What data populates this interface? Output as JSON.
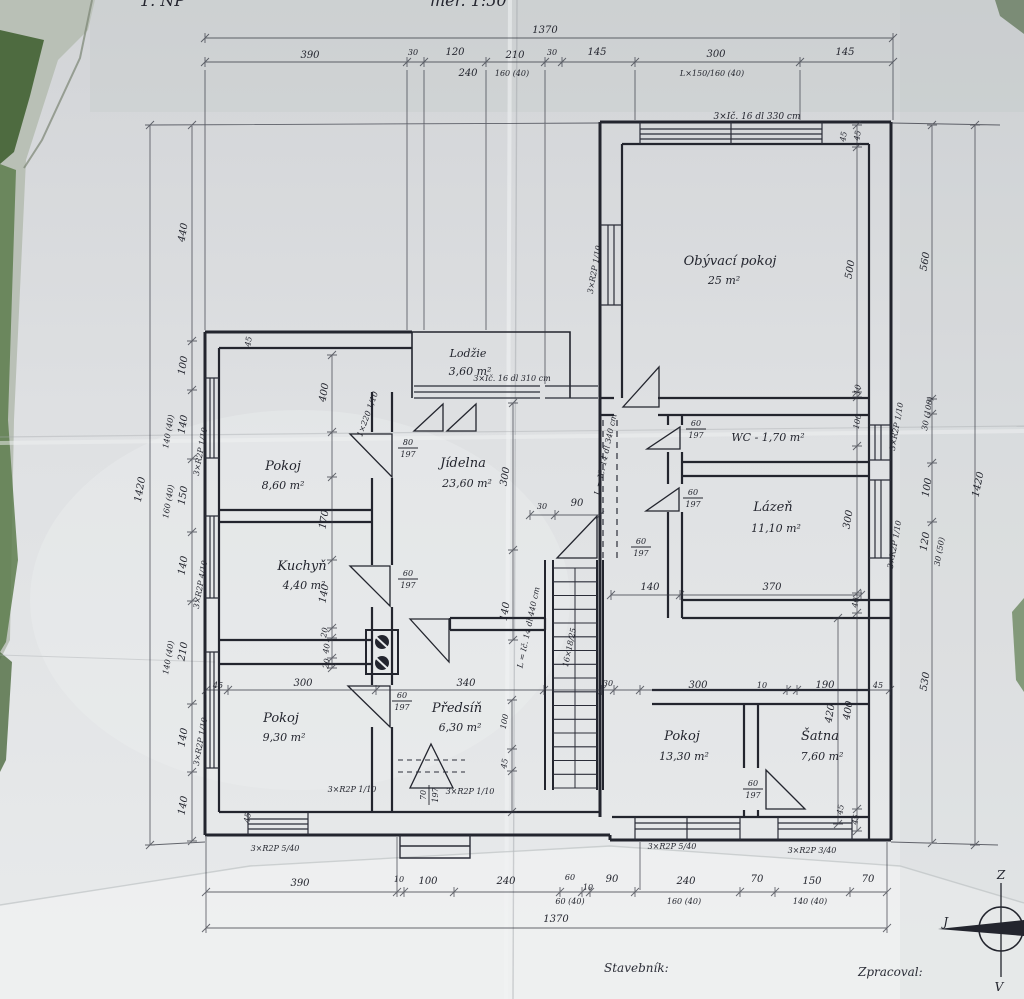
{
  "colors": {
    "ink": "#23252e",
    "ink_light": "#32343f",
    "paper": "#dfe1e3",
    "paper_bright": "#f1f3f3",
    "foliage": "#5d7c4e",
    "foliage_dark": "#3f5a35"
  },
  "title": {
    "left": "1. NP",
    "right": "měř. 1:50"
  },
  "footer": {
    "stavebnik": "Stavebník:",
    "zpracoval": "Zpracoval:"
  },
  "compass": {
    "top": "Z",
    "bottom": "V",
    "left": "J"
  },
  "rooms": [
    {
      "name": "Obývací pokoj",
      "area": "25 m²",
      "x": 730,
      "y": 265,
      "ax": 724,
      "ay": 284
    },
    {
      "name": "Lodžie",
      "area": "3,60 m²",
      "x": 468,
      "y": 357,
      "ax": 470,
      "ay": 375,
      "s": 11
    },
    {
      "name": "Pokoj",
      "area": "8,60 m²",
      "x": 283,
      "y": 470,
      "ax": 283,
      "ay": 489
    },
    {
      "name": "Jídelna",
      "area": "23,60 m²",
      "x": 463,
      "y": 467,
      "ax": 467,
      "ay": 487
    },
    {
      "name": "Kuchyň",
      "area": "4,40 m²",
      "x": 302,
      "y": 570,
      "ax": 304,
      "ay": 589
    },
    {
      "name": "WC - 1,70 m²",
      "area": "",
      "x": 768,
      "y": 441,
      "s": 11
    },
    {
      "name": "Lázeň",
      "area": "11,10 m²",
      "x": 773,
      "y": 511,
      "ax": 776,
      "ay": 532
    },
    {
      "name": "Pokoj",
      "area": "9,30 m²",
      "x": 281,
      "y": 722,
      "ax": 284,
      "ay": 741
    },
    {
      "name": "Předsíň",
      "area": "6,30 m²",
      "x": 457,
      "y": 712,
      "ax": 460,
      "ay": 731
    },
    {
      "name": "Pokoj",
      "area": "13,30 m²",
      "x": 682,
      "y": 740,
      "ax": 684,
      "ay": 760
    },
    {
      "name": "Šatna",
      "area": "7,60 m²",
      "x": 820,
      "y": 740,
      "ax": 822,
      "ay": 760
    }
  ],
  "dimensions": [
    {
      "t": "1370",
      "x": 545,
      "y": 33
    },
    {
      "t": "390",
      "x": 310,
      "y": 58
    },
    {
      "t": "30",
      "x": 413,
      "y": 55,
      "s": 8
    },
    {
      "t": "120",
      "x": 455,
      "y": 55
    },
    {
      "t": "240",
      "x": 468,
      "y": 76
    },
    {
      "t": "210",
      "x": 515,
      "y": 58
    },
    {
      "t": "160 (40)",
      "x": 512,
      "y": 76,
      "s": 8
    },
    {
      "t": "30",
      "x": 552,
      "y": 55,
      "s": 8
    },
    {
      "t": "145",
      "x": 597,
      "y": 55
    },
    {
      "t": "300",
      "x": 716,
      "y": 57
    },
    {
      "t": "L×150/160 (40)",
      "x": 712,
      "y": 76,
      "s": 8
    },
    {
      "t": "145",
      "x": 845,
      "y": 55
    },
    {
      "t": "390",
      "x": 300,
      "y": 886
    },
    {
      "t": "10",
      "x": 399,
      "y": 882,
      "s": 8
    },
    {
      "t": "100",
      "x": 428,
      "y": 884
    },
    {
      "t": "240",
      "x": 506,
      "y": 884
    },
    {
      "t": "60",
      "x": 570,
      "y": 880,
      "s": 8
    },
    {
      "t": "60 (40)",
      "x": 570,
      "y": 904,
      "s": 8
    },
    {
      "t": "10",
      "x": 588,
      "y": 890,
      "s": 8
    },
    {
      "t": "90",
      "x": 612,
      "y": 882
    },
    {
      "t": "240",
      "x": 686,
      "y": 884
    },
    {
      "t": "160 (40)",
      "x": 684,
      "y": 904,
      "s": 8
    },
    {
      "t": "70",
      "x": 757,
      "y": 882
    },
    {
      "t": "150",
      "x": 812,
      "y": 884
    },
    {
      "t": "140 (40)",
      "x": 810,
      "y": 904,
      "s": 8
    },
    {
      "t": "70",
      "x": 868,
      "y": 882
    },
    {
      "t": "1370",
      "x": 556,
      "y": 922
    },
    {
      "t": "1420",
      "x": 143,
      "y": 490,
      "rot": -80
    },
    {
      "t": "440",
      "x": 186,
      "y": 233,
      "rot": -80
    },
    {
      "t": "100",
      "x": 186,
      "y": 366,
      "rot": -80
    },
    {
      "t": "140",
      "x": 186,
      "y": 425,
      "rot": -80
    },
    {
      "t": "140 (40)",
      "x": 171,
      "y": 432,
      "rot": -80,
      "s": 8
    },
    {
      "t": "150",
      "x": 186,
      "y": 496,
      "rot": -80
    },
    {
      "t": "160 (40)",
      "x": 171,
      "y": 502,
      "rot": -80,
      "s": 8
    },
    {
      "t": "140",
      "x": 186,
      "y": 566,
      "rot": -80
    },
    {
      "t": "210",
      "x": 186,
      "y": 652,
      "rot": -80
    },
    {
      "t": "140 (40)",
      "x": 171,
      "y": 658,
      "rot": -80,
      "s": 8
    },
    {
      "t": "140",
      "x": 186,
      "y": 738,
      "rot": -80
    },
    {
      "t": "140",
      "x": 186,
      "y": 806,
      "rot": -80
    },
    {
      "t": "45",
      "x": 860,
      "y": 136,
      "rot": -80,
      "s": 8
    },
    {
      "t": "500",
      "x": 853,
      "y": 270,
      "rot": -80
    },
    {
      "t": "10",
      "x": 860,
      "y": 390,
      "rot": -80,
      "s": 8
    },
    {
      "t": "100",
      "x": 860,
      "y": 422,
      "rot": -80,
      "s": 8
    },
    {
      "t": "300",
      "x": 851,
      "y": 520,
      "rot": -80
    },
    {
      "t": "40",
      "x": 858,
      "y": 603,
      "rot": -80,
      "s": 8
    },
    {
      "t": "400",
      "x": 851,
      "y": 711,
      "rot": -80
    },
    {
      "t": "45",
      "x": 858,
      "y": 820,
      "rot": -80,
      "s": 8
    },
    {
      "t": "560",
      "x": 928,
      "y": 262,
      "rot": -80
    },
    {
      "t": "30 (100)",
      "x": 930,
      "y": 414,
      "rot": -80,
      "s": 8
    },
    {
      "t": "100",
      "x": 930,
      "y": 488,
      "rot": -80
    },
    {
      "t": "120",
      "x": 928,
      "y": 542,
      "rot": -80
    },
    {
      "t": "30 (50)",
      "x": 942,
      "y": 552,
      "rot": -80,
      "s": 8
    },
    {
      "t": "530",
      "x": 928,
      "y": 682,
      "rot": -80
    },
    {
      "t": "1420",
      "x": 981,
      "y": 485,
      "rot": -78
    },
    {
      "t": "300",
      "x": 508,
      "y": 477,
      "rot": -80
    },
    {
      "t": "30",
      "x": 542,
      "y": 509,
      "s": 8
    },
    {
      "t": "90",
      "x": 577,
      "y": 506
    },
    {
      "t": "140",
      "x": 508,
      "y": 612,
      "rot": -80
    },
    {
      "t": "400",
      "x": 327,
      "y": 393,
      "rot": -80
    },
    {
      "t": "170",
      "x": 327,
      "y": 520,
      "rot": -80
    },
    {
      "t": "140",
      "x": 327,
      "y": 594,
      "rot": -80
    },
    {
      "t": "20",
      "x": 327,
      "y": 633,
      "rot": -80,
      "s": 8
    },
    {
      "t": "40",
      "x": 329,
      "y": 649,
      "rot": -80,
      "s": 8
    },
    {
      "t": "20",
      "x": 329,
      "y": 664,
      "rot": -80,
      "s": 8
    },
    {
      "t": "45",
      "x": 251,
      "y": 342,
      "rot": -80,
      "s": 8
    },
    {
      "t": "45",
      "x": 846,
      "y": 137,
      "rot": -80,
      "s": 8
    },
    {
      "t": "45",
      "x": 218,
      "y": 688,
      "s": 8
    },
    {
      "t": "300",
      "x": 303,
      "y": 686
    },
    {
      "t": "340",
      "x": 466,
      "y": 686
    },
    {
      "t": "30",
      "x": 608,
      "y": 686,
      "s": 8
    },
    {
      "t": "300",
      "x": 698,
      "y": 688
    },
    {
      "t": "10",
      "x": 762,
      "y": 688,
      "s": 8
    },
    {
      "t": "190",
      "x": 825,
      "y": 688
    },
    {
      "t": "45",
      "x": 878,
      "y": 688,
      "s": 8
    },
    {
      "t": "140",
      "x": 650,
      "y": 590
    },
    {
      "t": "370",
      "x": 772,
      "y": 590
    },
    {
      "t": "420",
      "x": 833,
      "y": 714,
      "rot": -80
    },
    {
      "t": "45",
      "x": 843,
      "y": 810,
      "rot": -80,
      "s": 8
    },
    {
      "t": "100",
      "x": 507,
      "y": 722,
      "rot": -80,
      "s": 8
    },
    {
      "t": "45",
      "x": 507,
      "y": 764,
      "rot": -80,
      "s": 8
    },
    {
      "t": "45",
      "x": 250,
      "y": 818,
      "rot": -80,
      "s": 8
    }
  ],
  "annotations": [
    {
      "t": "3×Ič. 16 dl 330 cm",
      "x": 757,
      "y": 119,
      "s": 9
    },
    {
      "t": "3×Ič. 16 dl 310 cm",
      "x": 512,
      "y": 381,
      "s": 8
    },
    {
      "t": "L = Ič. 14 dl 340 cm",
      "x": 608,
      "y": 455,
      "rot": -78,
      "s": 8
    },
    {
      "t": "L = Ič. 14 dl 440 cm",
      "x": 531,
      "y": 628,
      "rot": -78,
      "s": 8
    },
    {
      "t": "16×18/25",
      "x": 572,
      "y": 648,
      "rot": -78,
      "s": 8
    },
    {
      "t": "3×R2P 1/10",
      "x": 203,
      "y": 452,
      "rot": -80,
      "s": 8
    },
    {
      "t": "3×R2P 4/10",
      "x": 203,
      "y": 585,
      "rot": -80,
      "s": 8
    },
    {
      "t": "3×R2P 1/10",
      "x": 203,
      "y": 742,
      "rot": -80,
      "s": 8
    },
    {
      "t": "3×R2P 1/10",
      "x": 597,
      "y": 270,
      "rot": -80,
      "s": 8
    },
    {
      "t": "3×R2P 1/10",
      "x": 899,
      "y": 427,
      "rot": -80,
      "s": 8
    },
    {
      "t": "3×R2P 1/10",
      "x": 897,
      "y": 545,
      "rot": -80,
      "s": 8
    },
    {
      "t": "1×220 1/10",
      "x": 370,
      "y": 415,
      "rot": -70,
      "s": 8
    },
    {
      "t": "3×R2P 5/40",
      "x": 672,
      "y": 849,
      "s": 8
    },
    {
      "t": "3×R2P 3/40",
      "x": 812,
      "y": 853,
      "s": 8
    },
    {
      "t": "3×R2P 5/40",
      "x": 275,
      "y": 851,
      "s": 8
    },
    {
      "t": "3×R2P 1/10",
      "x": 352,
      "y": 792,
      "s": 8
    },
    {
      "t": "3×R2P 1/10",
      "x": 470,
      "y": 794,
      "s": 8
    }
  ],
  "fractions": [
    {
      "n": "80",
      "d": "197",
      "x": 408,
      "y": 447
    },
    {
      "n": "60",
      "d": "197",
      "x": 408,
      "y": 578
    },
    {
      "n": "60",
      "d": "197",
      "x": 402,
      "y": 700
    },
    {
      "n": "60",
      "d": "197",
      "x": 696,
      "y": 428
    },
    {
      "n": "60",
      "d": "197",
      "x": 693,
      "y": 497
    },
    {
      "n": "60",
      "d": "197",
      "x": 641,
      "y": 546
    },
    {
      "n": "60",
      "d": "197",
      "x": 753,
      "y": 788
    },
    {
      "n": "70",
      "d": "197",
      "x": 428,
      "y": 795,
      "rot": -90
    }
  ]
}
